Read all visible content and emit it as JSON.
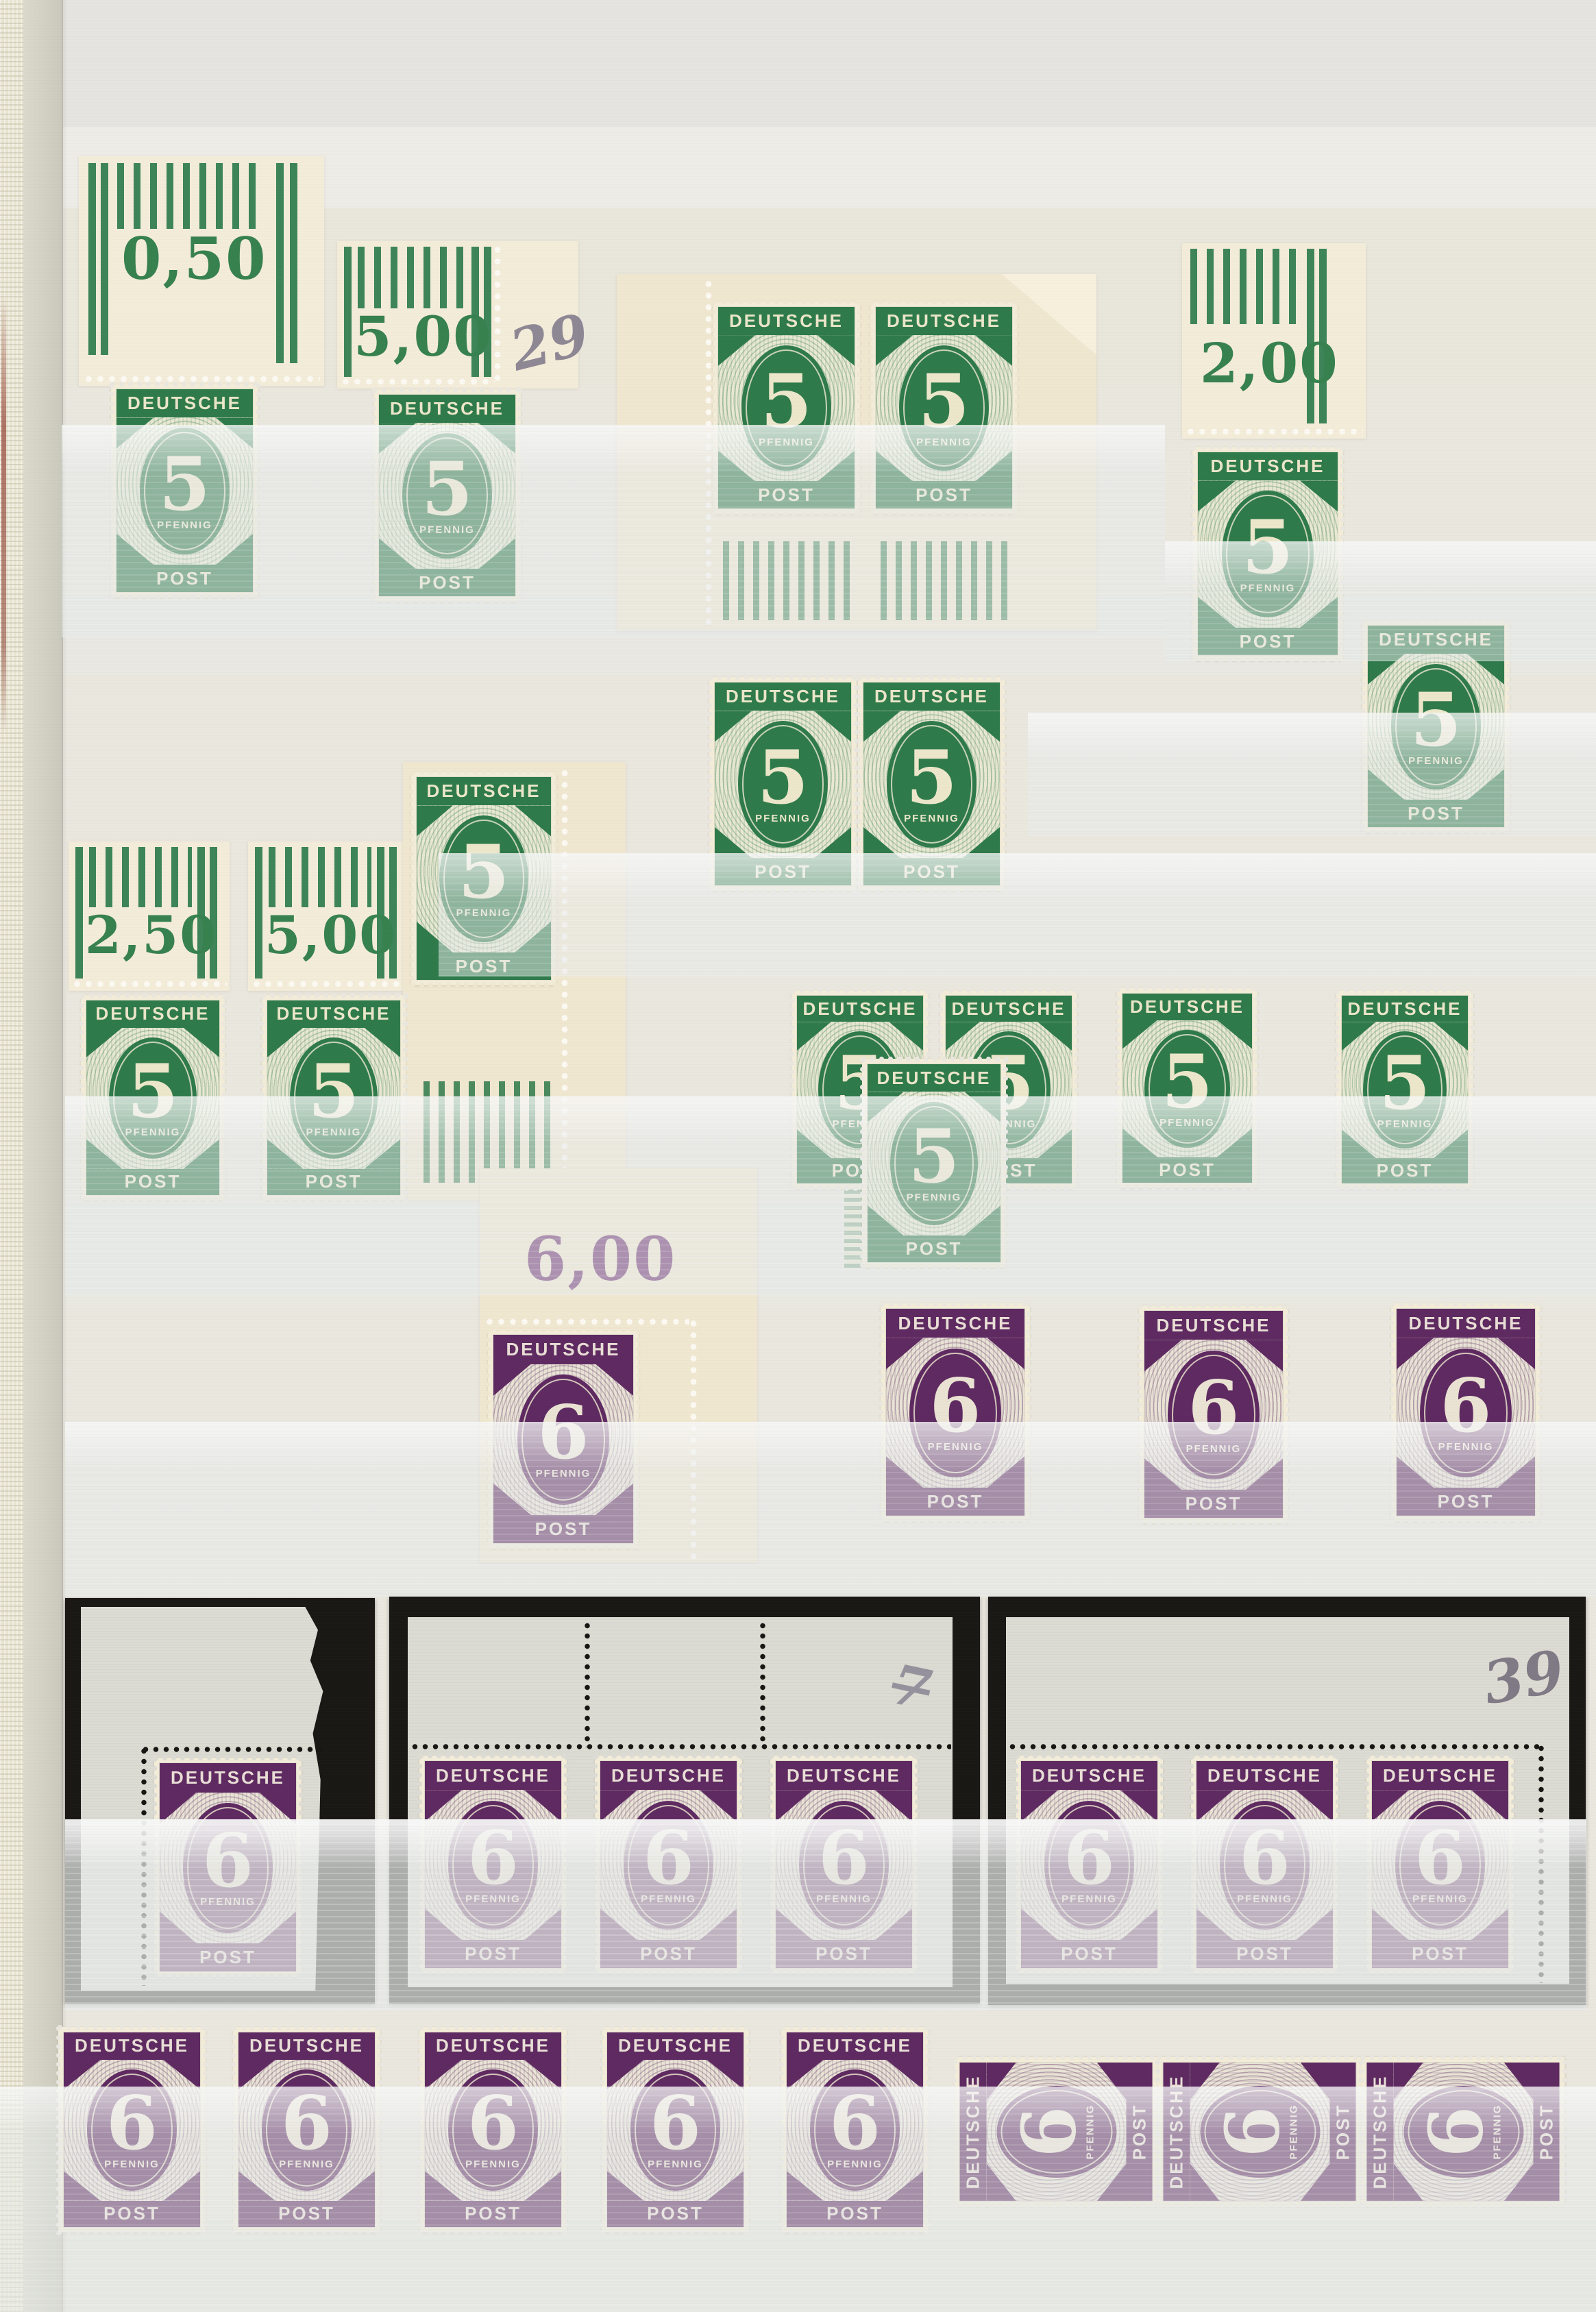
{
  "designs": {
    "green5": {
      "country": "DEUTSCHE",
      "denomination": "5",
      "currency": "PFENNIG",
      "service": "POST",
      "color": "#2f7a4a"
    },
    "purple6": {
      "country": "DEUTSCHE",
      "denomination": "6",
      "currency": "PFENNIG",
      "service": "POST",
      "color": "#5e2a61"
    }
  },
  "margin_labels": {
    "row1_a": "0,50",
    "row1_b": "5,00",
    "row1_d": "2,00",
    "row2_f": "2,50",
    "row2_g": "5,00",
    "green_sheet": "6,00"
  },
  "handwritten": {
    "row1_note": "29",
    "mid_card_note": "7",
    "right_card_note": "39"
  },
  "cards": {
    "left_label": "0,60",
    "mid_labels": [
      "4,80",
      "5,40",
      "6,00"
    ],
    "right_labels": [
      "4,80",
      "5,40",
      "6,00"
    ]
  },
  "palette": {
    "page": "#eae7df",
    "green_dark": "#2f7a4a",
    "purple_dark": "#5e2a61",
    "selvage_cream": "#f3ecd9",
    "card_black": "#191815",
    "pencil_gray": "#7d7689"
  }
}
